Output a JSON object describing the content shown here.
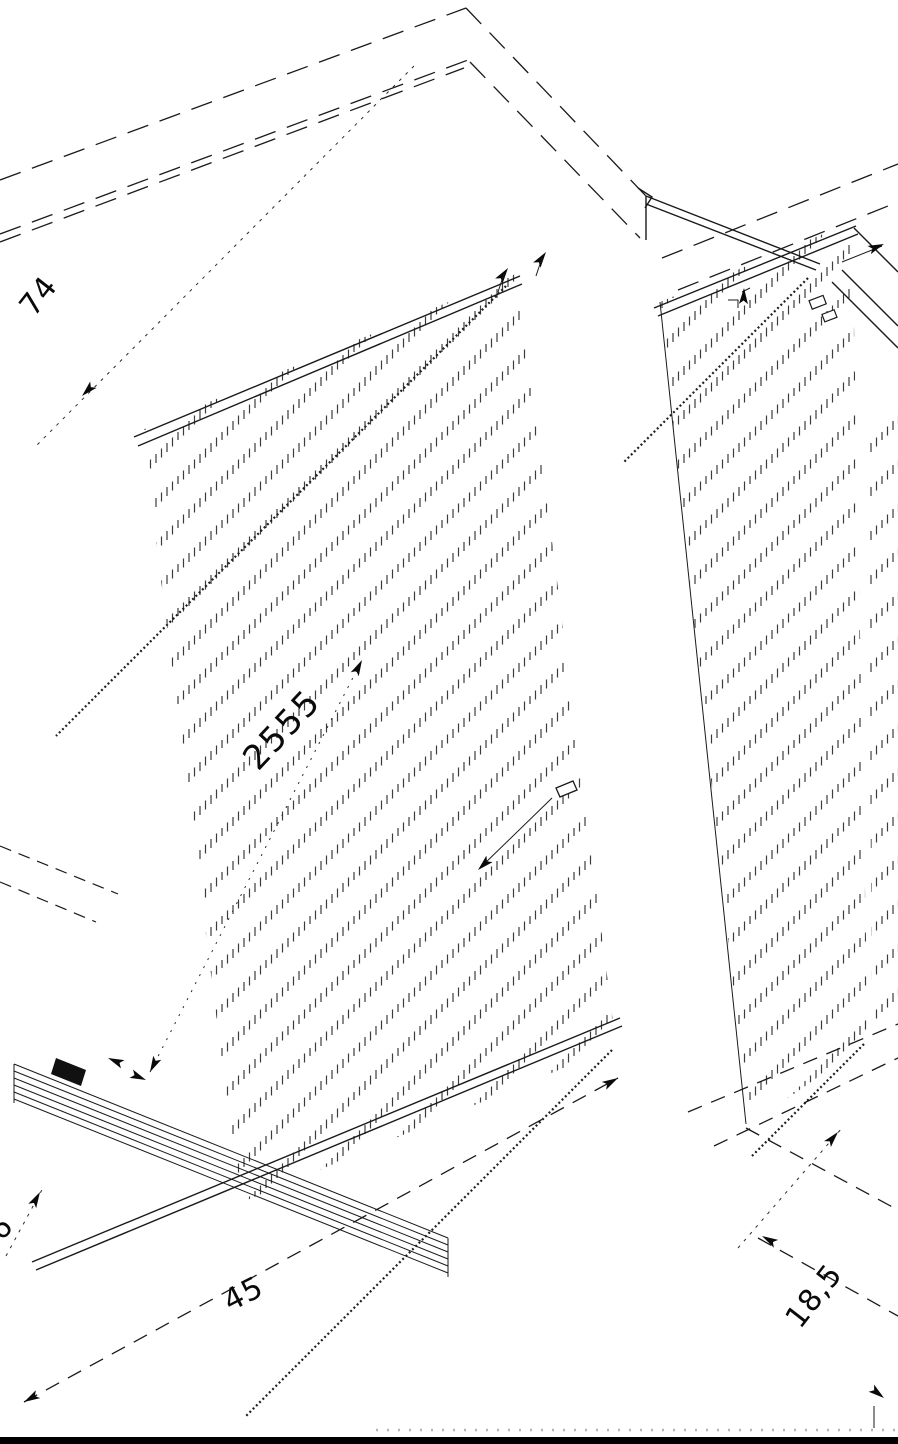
{
  "drawing": {
    "type": "isometric-cad-furniture-drawing",
    "background": "#ffffff",
    "line_color": "#1a1a1a",
    "dimensions": {
      "top_left": "74",
      "diagonal": "2555",
      "bottom": "45",
      "bottom_right": "18,5",
      "left_edge": "6"
    }
  }
}
